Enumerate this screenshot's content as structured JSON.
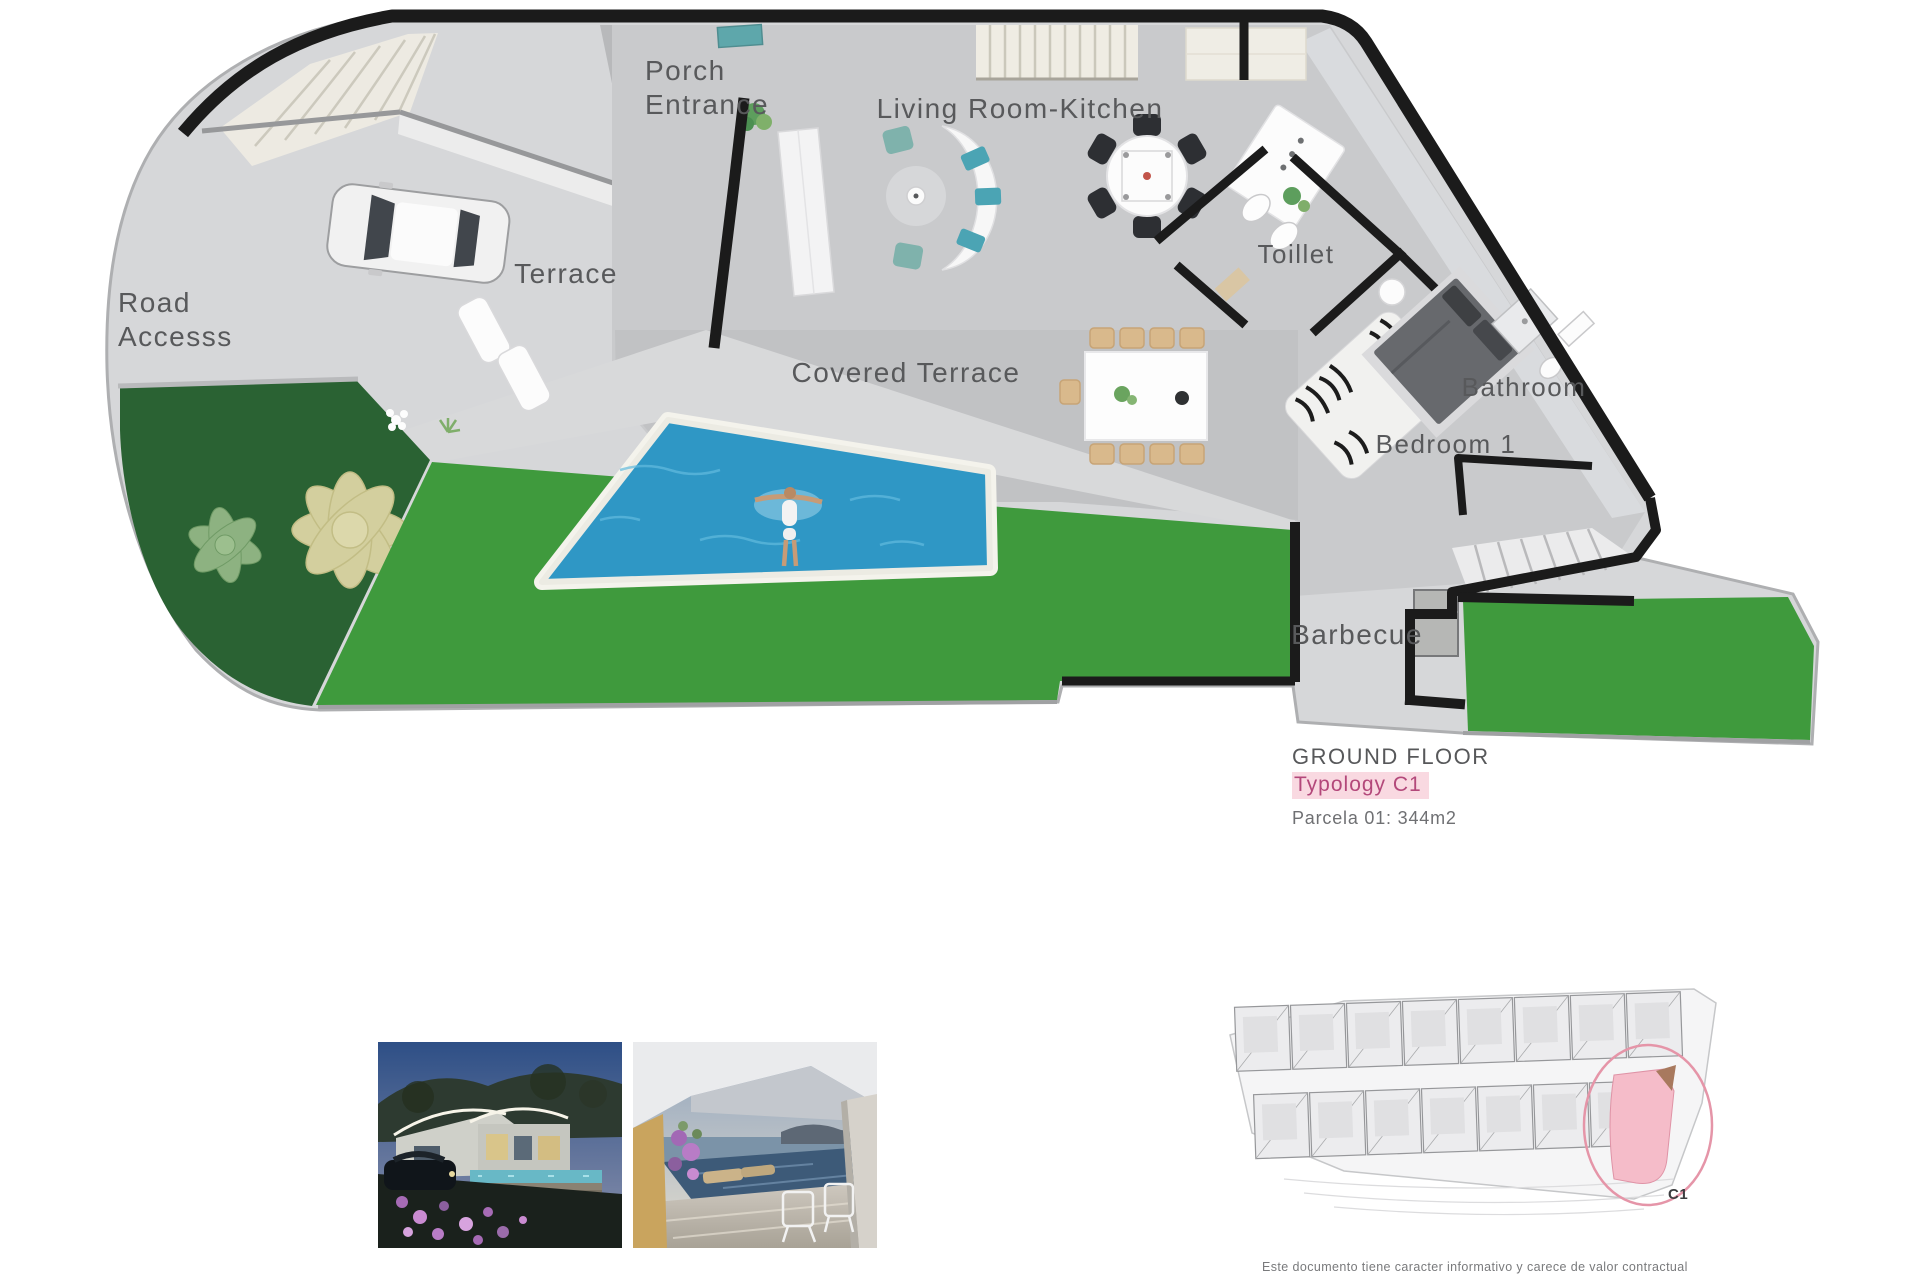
{
  "plan": {
    "labels": {
      "porch_line1": "Porch",
      "porch_line2": "Entrance",
      "living": "Living Room-Kitchen",
      "terrace": "Terrace",
      "road_line1": "Road",
      "road_line2": "Accesss",
      "covered_terrace": "Covered Terrace",
      "toilet": "Toillet",
      "bathroom": "Bathroom",
      "bedroom": "Bedroom 1",
      "barbecue": "Barbecue"
    },
    "colors": {
      "wall": "#1b1b1b",
      "lawn": "#3f9a3d",
      "garden": "#2a6233",
      "pool": "#2f97c5",
      "floor": "#c9cacc",
      "deck": "#d8d9da",
      "road": "#d6d7d9",
      "teal_accent": "#5ea7ab",
      "label_grey": "#58595b"
    }
  },
  "legend": {
    "title": "GROUND FLOOR",
    "typology": "Typology C1",
    "parcel": "Parcela 01: 344m2",
    "typology_text_color": "#b3487a",
    "typology_highlight": "#f9d9e1"
  },
  "site_plan": {
    "unit_label": "C1",
    "highlight_color": "#f5bcc9",
    "circle_color": "#e595a8",
    "rows": [
      8,
      7
    ]
  },
  "photos": [
    {
      "name": "villa-exterior-night"
    },
    {
      "name": "covered-terrace-sea-view"
    }
  ],
  "disclaimer": "Este documento tiene caracter informativo y carece de valor contractual"
}
